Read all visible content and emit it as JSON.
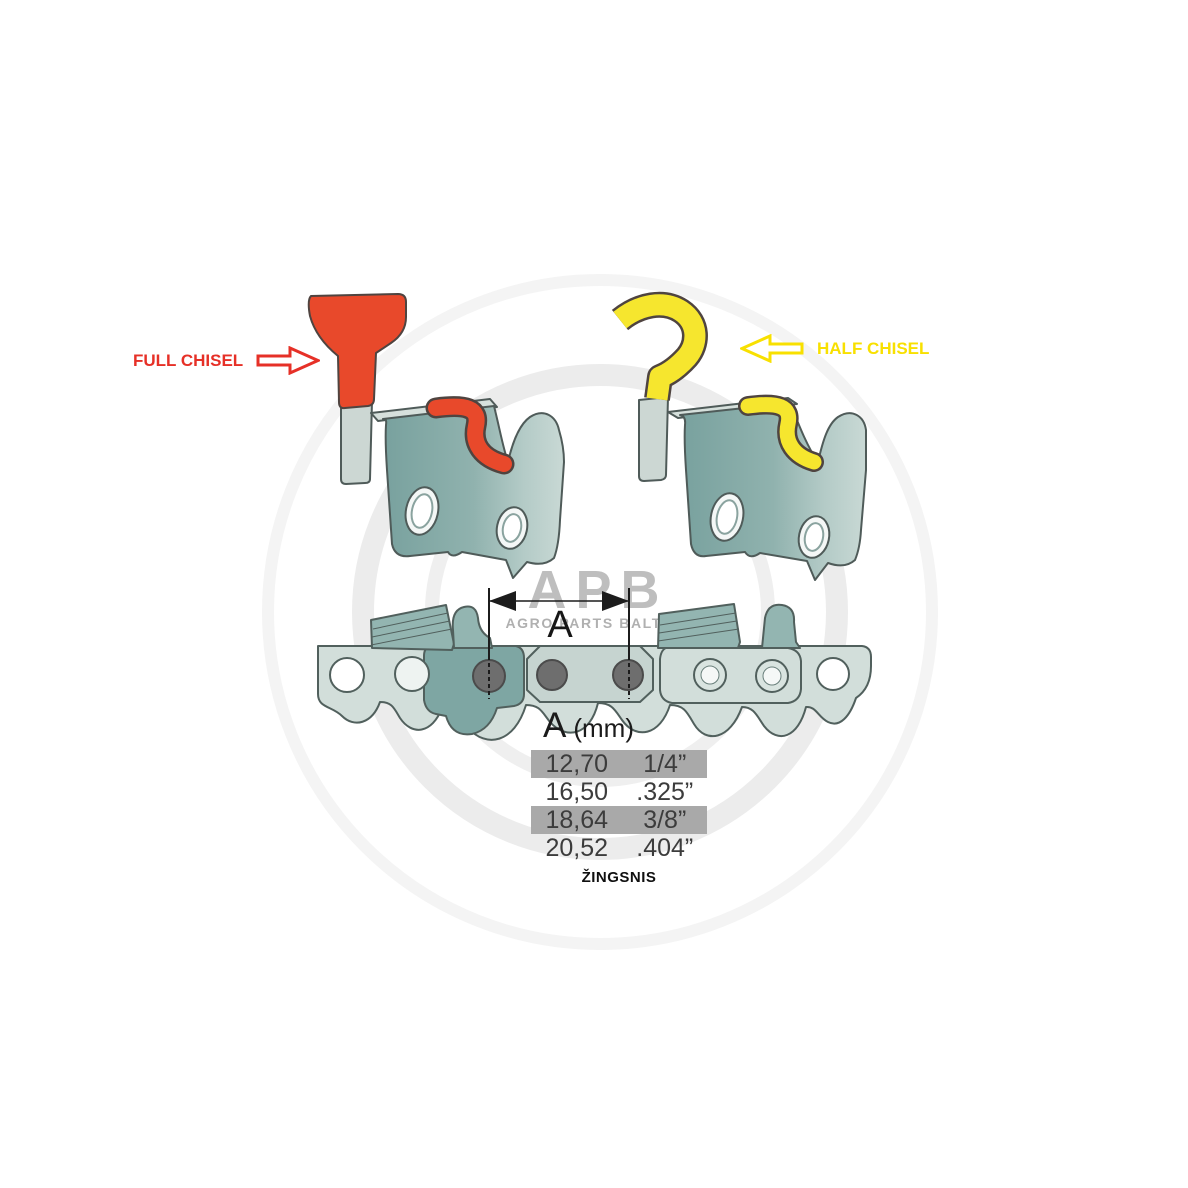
{
  "labels": {
    "full_chisel": "FULL CHISEL",
    "half_chisel": "HALF CHISEL"
  },
  "dimension": {
    "label": "A"
  },
  "watermark": {
    "brand": "APB",
    "tagline": "AGRO PARTS BALTIJA"
  },
  "table": {
    "header_a": "A",
    "header_unit": "(mm)",
    "rows": [
      {
        "mm": "12,70",
        "inch": "1/4”",
        "highlighted": true
      },
      {
        "mm": "16,50",
        "inch": ".325”",
        "highlighted": false
      },
      {
        "mm": "18,64",
        "inch": "3/8”",
        "highlighted": true
      },
      {
        "mm": "20,52",
        "inch": ".404”",
        "highlighted": false
      }
    ],
    "footer": "ŽINGSNIS"
  },
  "colors": {
    "full_chisel_red": "#e8492b",
    "half_chisel_yellow": "#f6e62e",
    "label_red": "#e63027",
    "label_yellow": "#f8e000",
    "chain_teal_dark": "#7ea6a3",
    "chain_teal_light": "#d2deda",
    "row_highlight": "#a9a9a9",
    "rivet_gray": "#6e6e6e"
  }
}
